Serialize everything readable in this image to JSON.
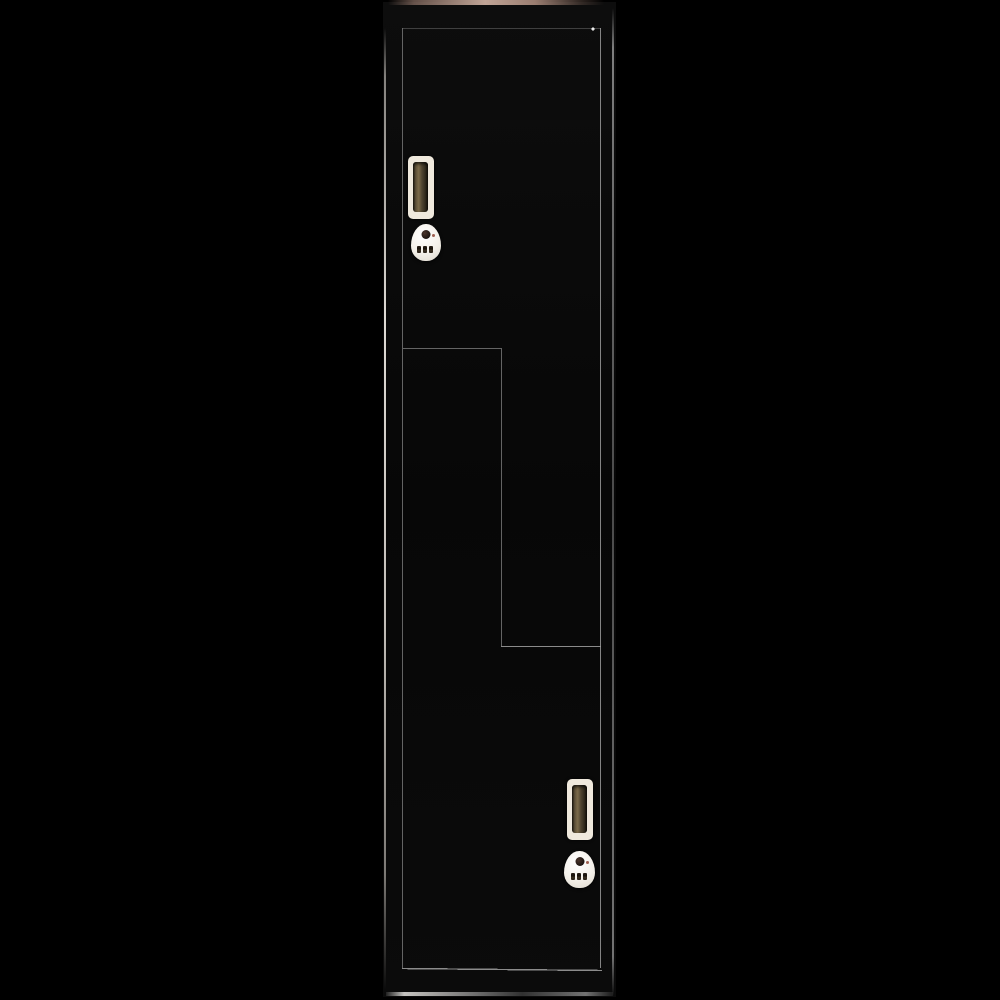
{
  "scene": {
    "description": "Product photo of a tall black Z-style two-door storage locker on a black background",
    "visible_text": ""
  },
  "colors": {
    "background": "#000000",
    "body": "#0a0a0a",
    "seam": "#6e6e6e",
    "seam_bright": "#9a9a9a",
    "seam_dim": "#454545",
    "edge_highlight": "#e6e1da",
    "top_face": "#c0a496",
    "handle_frame": "#efe9dd",
    "lock_body": "#f4f0e9",
    "lock_knob": "#1c1410",
    "lock_dial": "#2a2118",
    "lock_led": "#8a3a28"
  },
  "locker": {
    "style": "Z-door",
    "finish": "gloss black",
    "door_count": 2,
    "doors": [
      {
        "id": "upper-door",
        "shape": "Z (full width top, right column below)",
        "handle": "recessed vertical pull, cream frame with bronze slot",
        "lock": "white teardrop 3-dial combination lock with dark knob"
      },
      {
        "id": "lower-door",
        "shape": "Z (left column above, full width bottom)",
        "handle": "recessed vertical pull, cream frame with bronze slot",
        "lock": "white teardrop 3-dial combination lock with dark knob"
      }
    ],
    "lock_dials_per_lock": 3
  }
}
